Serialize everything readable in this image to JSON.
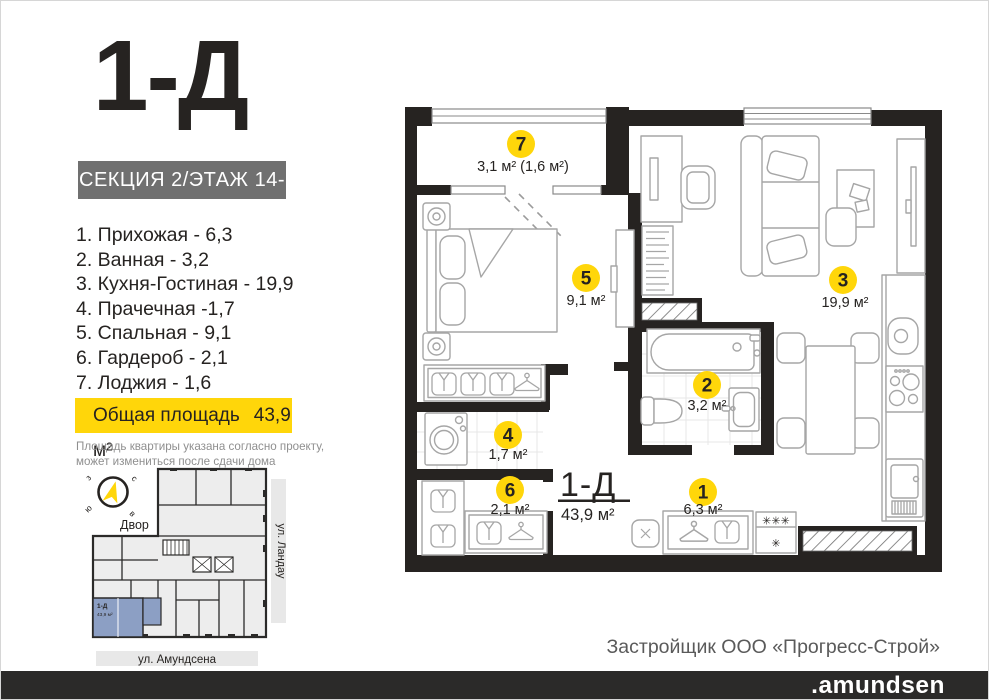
{
  "header": {
    "title": "1-Д",
    "section_badge": "СЕКЦИЯ 2/ЭТАЖ 14-15"
  },
  "room_list": [
    "1. Прихожая - 6,3",
    "2. Ванная - 3,2",
    "3. Кухня-Гостиная - 19,9",
    "4. Прачечная -1,7",
    "5. Спальная - 9,1",
    "6. Гардероб - 2,1",
    "7. Лоджия - 1,6"
  ],
  "total_area": {
    "label": "Общая площадь",
    "value": "43,9 м²"
  },
  "disclaimer": {
    "line1": "Площадь квартиры указана согласно проекту,",
    "line2": "может измениться  после сдачи дома"
  },
  "mini_map": {
    "courtyard_label": "Двор",
    "street_right": "ул. Ландау",
    "street_bottom": "ул. Амундсена",
    "unit_label": "1-Д",
    "unit_area": "43,9 м²",
    "compass": {
      "n": "с",
      "w": "з",
      "s": "ю",
      "e": "в"
    }
  },
  "plan": {
    "unit_label": "1-Д",
    "unit_area": "43,9 м²",
    "rooms": [
      {
        "number": "1",
        "area": "6,3 м²"
      },
      {
        "number": "2",
        "area": "3,2 м²"
      },
      {
        "number": "3",
        "area": "19,9 м²"
      },
      {
        "number": "4",
        "area": "1,7 м²"
      },
      {
        "number": "5",
        "area": "9,1 м²"
      },
      {
        "number": "6",
        "area": "2,1 м²"
      },
      {
        "number": "7",
        "area": "3,1 м² (1,6 м²)"
      }
    ],
    "appliance_marks": {
      "freezer_top": "✳✳✳",
      "freezer_bottom": "✳"
    }
  },
  "footer": {
    "developer": "Застройщик ООО «Прогресс-Строй»",
    "brand": ".amundsen"
  },
  "colors": {
    "accent_yellow": "#ffd60a",
    "wall_dark": "#262321",
    "badge_gray": "#707070",
    "highlight_blue": "#8c9fc4",
    "footer_bar": "#2b2a29"
  }
}
